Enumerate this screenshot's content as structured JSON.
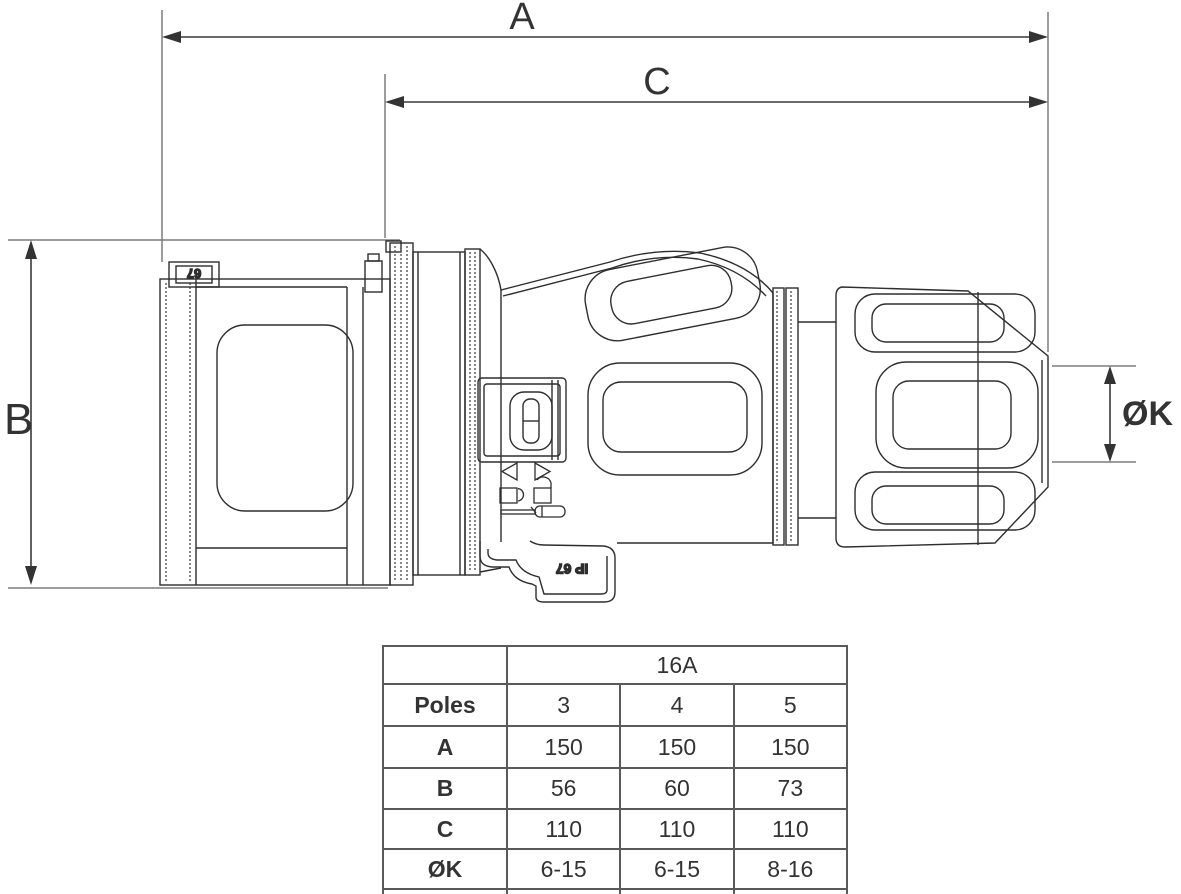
{
  "drawing": {
    "dimensions": {
      "a_label": "A",
      "b_label": "B",
      "c_label": "C",
      "k_label": "ØK"
    },
    "markings": {
      "cap_rating": "67",
      "body_rating": "IP 67"
    },
    "icons": [
      "triangle-left-icon",
      "triangle-right-icon",
      "padlock-open-icon",
      "padlock-closed-icon",
      "screwdriver-icon"
    ],
    "colors": {
      "line": "#2e2e2e",
      "dimension": "#3a3a3a",
      "extension": "#7d7d7d",
      "table_border": "#5a5a5a",
      "text": "#333333",
      "background": "#ffffff"
    }
  },
  "table": {
    "amp_header": "16A",
    "rows": [
      {
        "label": "Poles",
        "values": [
          "3",
          "4",
          "5"
        ]
      },
      {
        "label": "A",
        "values": [
          "150",
          "150",
          "150"
        ]
      },
      {
        "label": "B",
        "values": [
          "56",
          "60",
          "73"
        ]
      },
      {
        "label": "C",
        "values": [
          "110",
          "110",
          "110"
        ]
      },
      {
        "label": "ØK",
        "values": [
          "6-15",
          "6-15",
          "8-16"
        ]
      }
    ]
  }
}
